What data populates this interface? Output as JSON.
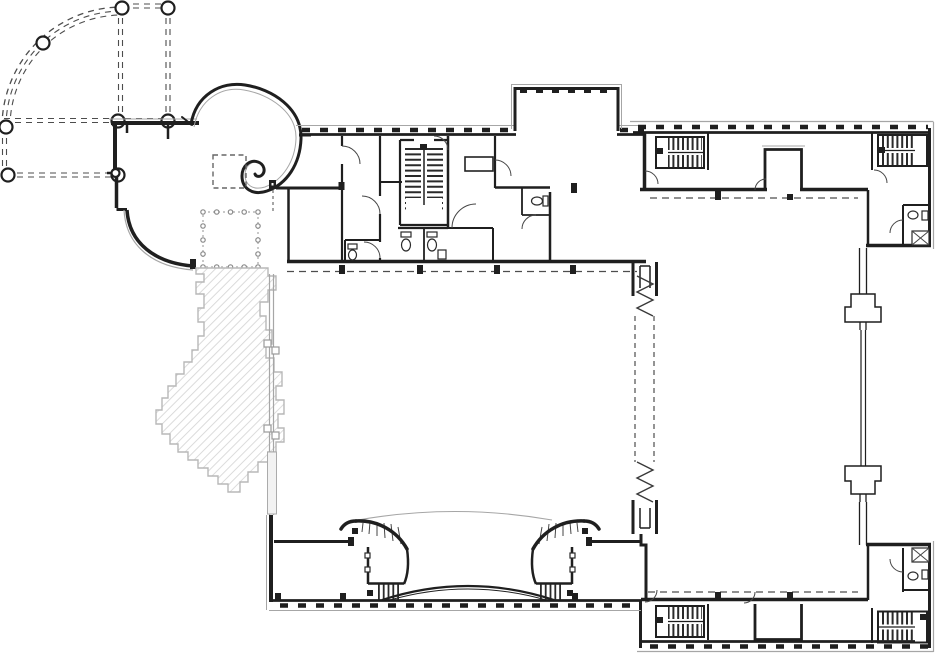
{
  "colors": {
    "wall": "#1f1f1f",
    "wall_light": "#454545",
    "gray": "#a6a6a6",
    "gray_soft": "#c9c9c9",
    "hatch": "#d4d4d4",
    "dash": "#4d4d4d",
    "paper": "#ffffff"
  },
  "drawing": {
    "type": "architectural-floor-plan",
    "features": [
      "quarter-circle-colonnade",
      "spiral-pavilion-wall",
      "west-curved-wing",
      "dashed-skylight-square",
      "column-grid-square",
      "stepped-hatch-terrace",
      "north-service-band",
      "switchback-stair-core",
      "restroom-cluster",
      "top-alcove-room",
      "central-hall",
      "south-entrance-band",
      "curved-twin-stairs",
      "entrance-arch",
      "expansion-joint-strip",
      "right-hall",
      "corner-stairs",
      "corner-restrooms",
      "curtain-wall-funnel-piers"
    ]
  }
}
